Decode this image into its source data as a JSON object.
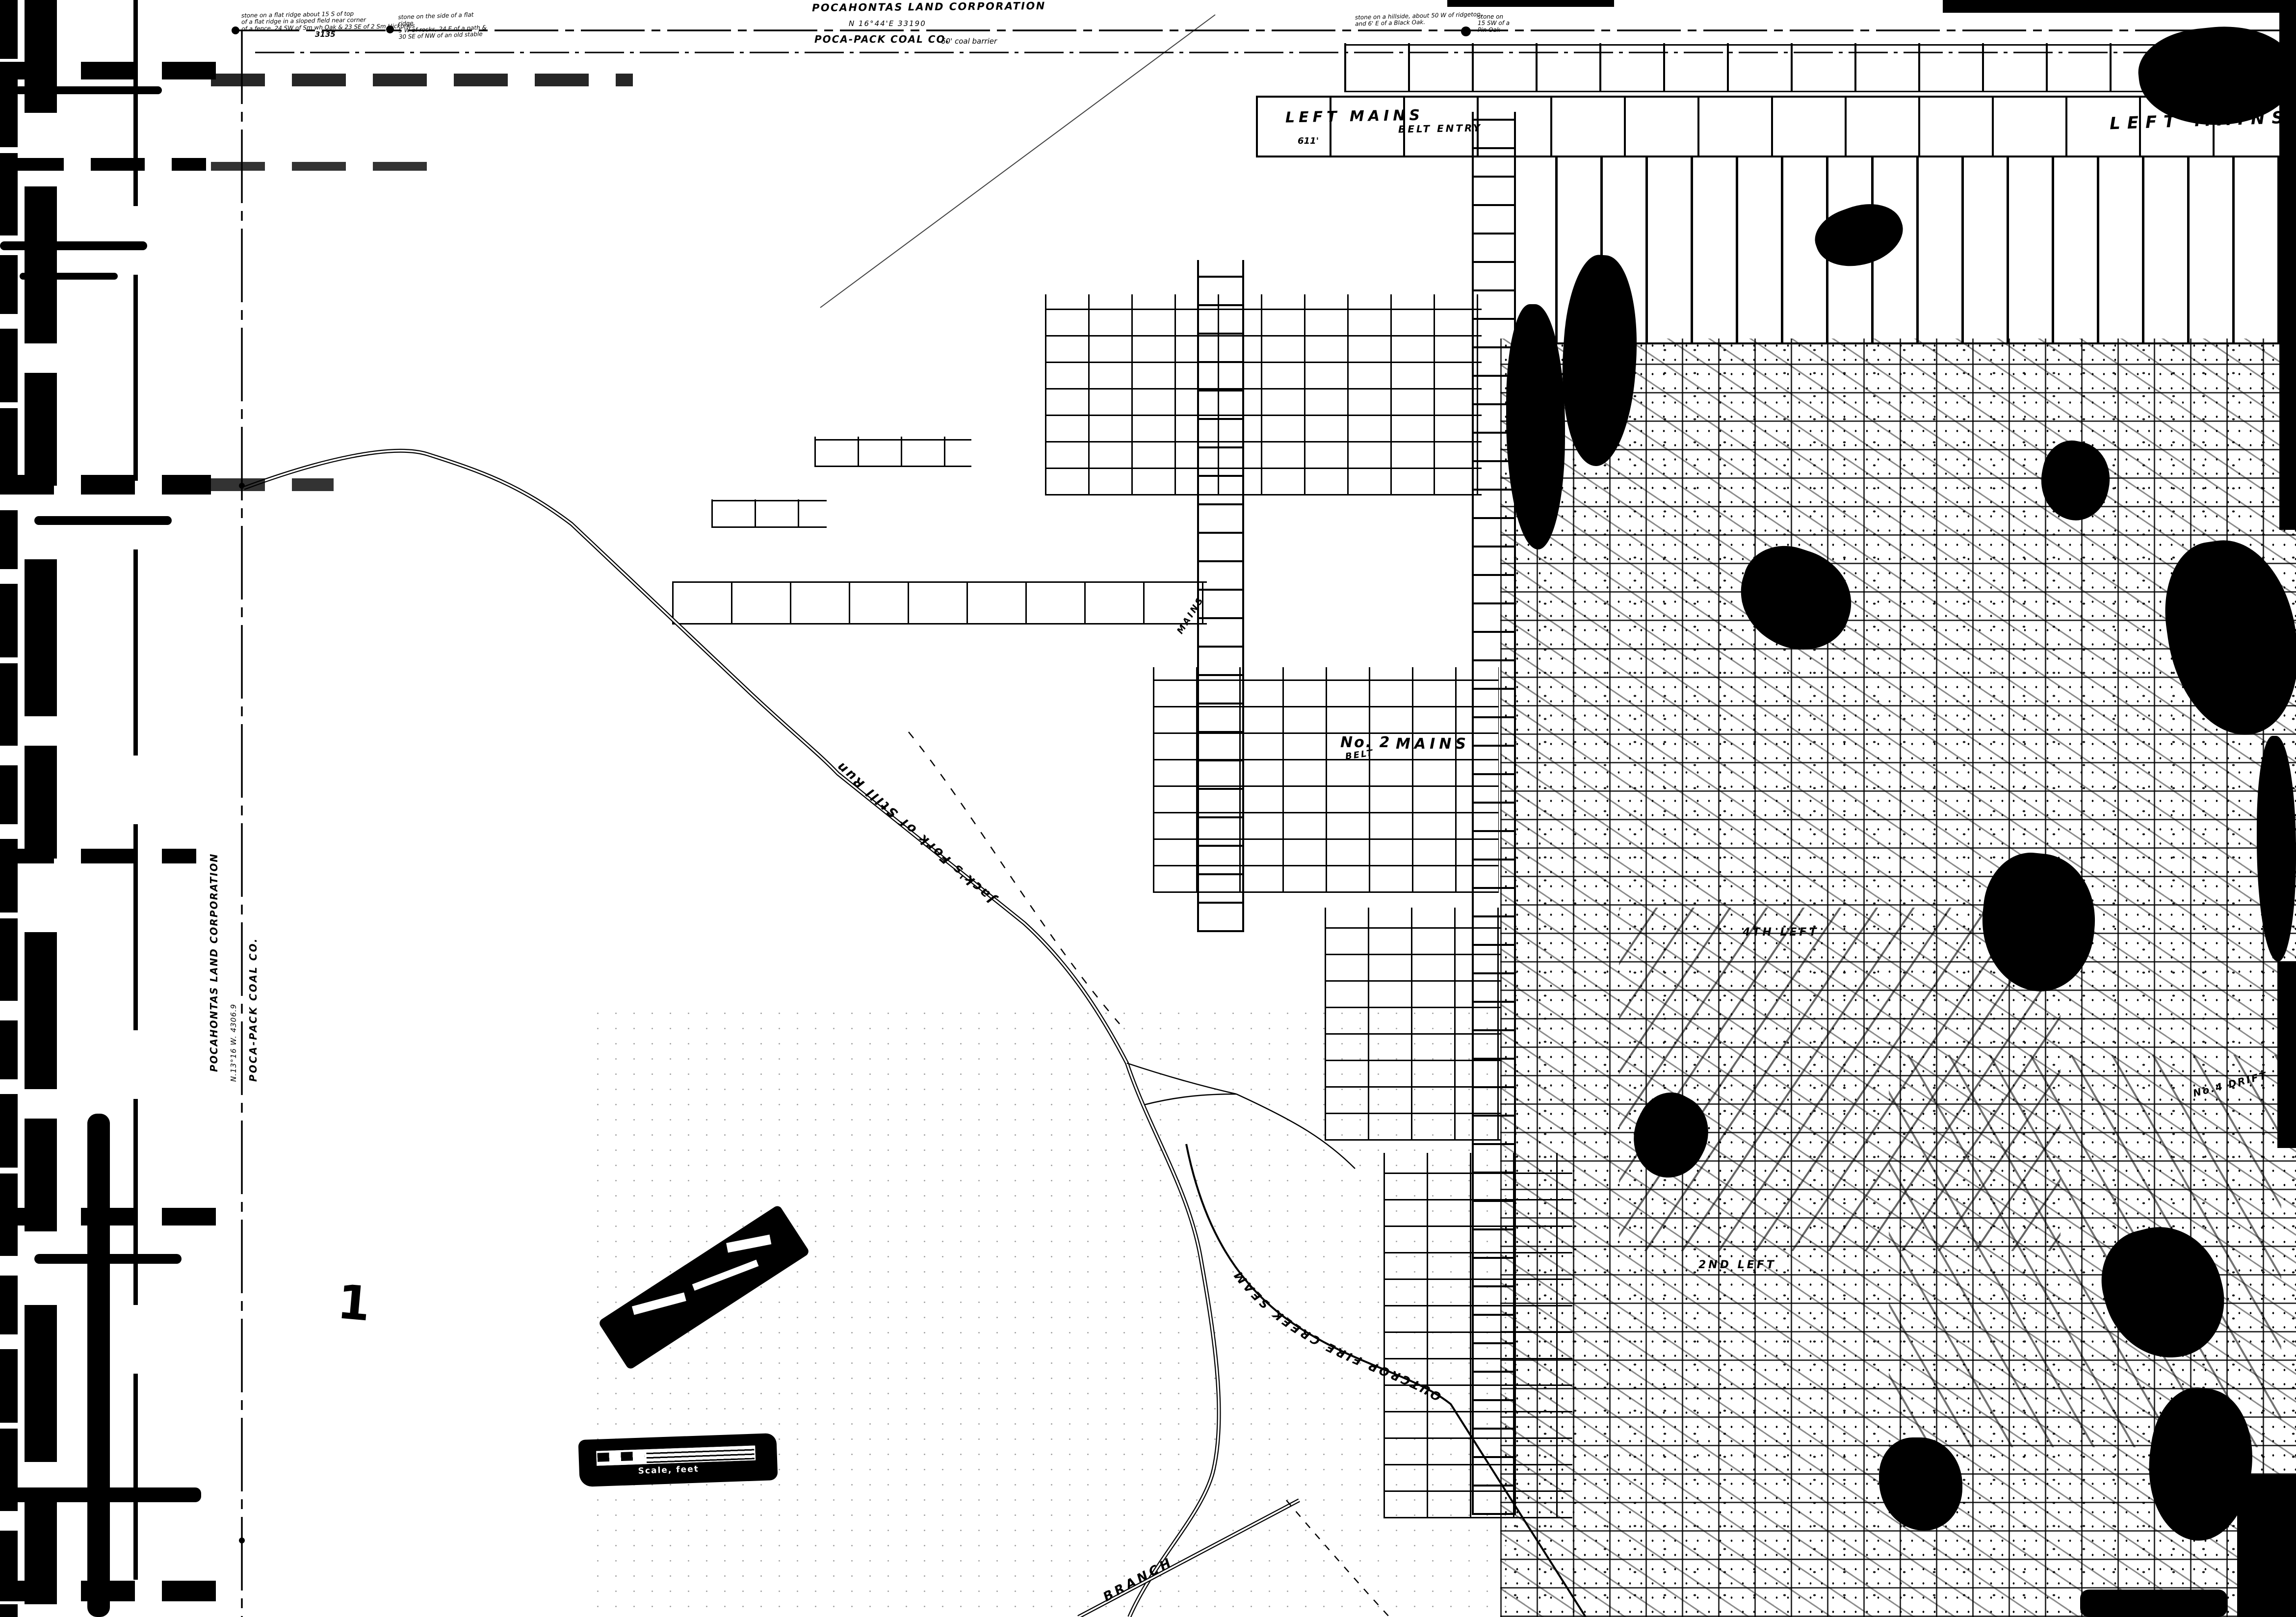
{
  "colors": {
    "ink": "#000000",
    "paper": "#ffffff"
  },
  "header": {
    "title": "POCAHONTAS LAND CORPORATION",
    "bearing": "N 16°44'E   33190",
    "company": "POCA-PACK COAL CO.",
    "barrier_note": "60' coal barrier",
    "distance_3135": "3135",
    "survey_note_1": "stone on a flat ridge about 15 S of top\nof a flat ridge in a sloped field near corner\nof a fence, 24 SW of Sm wh Oak & 23 SE of 2 Sm Hickories",
    "survey_note_2": "stone on the side of a flat ridge\n5 W of rocks, 24 E of a path &\n30 SE of NW of an old stable",
    "survey_note_3": "stone on a hillside, about 50 W of ridgetop,\nand 6' E of a Black Oak.",
    "survey_note_4": "stone on\n15 SW of a\nPin Oak"
  },
  "left_boundary": {
    "corporation": "POCAHONTAS LAND CORPORATION",
    "bearing": "N.13°16 W.   4306.9",
    "company": "POCA-PACK COAL CO."
  },
  "labels": {
    "left_mains_nw": "LEFT MAINS",
    "left_mains_ne": "LEFT MAINS",
    "belt_entry": "BELT ENTRY",
    "distance_611": "611'",
    "no2": "No. 2",
    "no2_mains": "MAINS",
    "belt": "BELT",
    "mains_vertical": "MAINS",
    "fourth_left": "4TH LEFT",
    "second_left": "2ND LEFT",
    "no4_drift": "No.4 DRIFT",
    "outcrop": "OUTCROP FIRE CREEK SEAM",
    "stream": "Jack's Fork of Still Run",
    "branch": "BRANCH",
    "sheet_number": "1"
  },
  "scale_bar": {
    "label": "Scale, feet"
  }
}
